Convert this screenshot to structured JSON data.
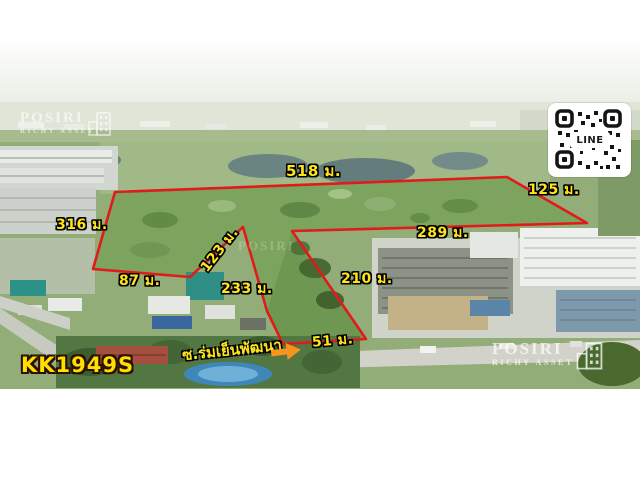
{
  "listing": {
    "code": "KK1949S",
    "road_name": "ซ.ร่มเย็นพัฒนา",
    "measurements": {
      "top": "518 ม.",
      "right": "125 ม.",
      "left": "316 ม.",
      "bottom_left": "87 ม.",
      "notch_side": "123 ม.",
      "notch_bottom": "233 ม.",
      "inner_diagonal": "210 ม.",
      "inner_top": "289 ม.",
      "frontage": "51 ม."
    }
  },
  "brand": {
    "name": "POSIRI",
    "tagline": "RICHY ASSET"
  },
  "qr": {
    "label": "LINE"
  },
  "colors": {
    "boundary": "#e11a1b",
    "label_text": "#ffe41a",
    "label_outline": "#000000",
    "arrow": "#f7941d",
    "code_text": "#ffdf00"
  }
}
